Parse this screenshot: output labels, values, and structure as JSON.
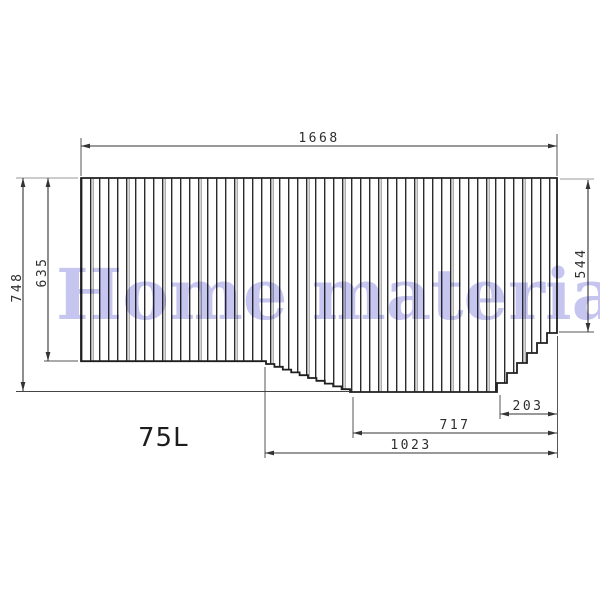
{
  "watermark": {
    "text": "Home material",
    "color": "#c5c5f0"
  },
  "product": {
    "size_label": "75L"
  },
  "dimensions": {
    "top_width": "1668",
    "overall_height": "748",
    "left_section_height": "635",
    "right_section_height": "544",
    "bottom_right_width": "203",
    "bottom_middle_width": "717",
    "bottom_left_width": "1023"
  },
  "colors": {
    "outline": "#1f1f1f",
    "dimension_line": "#333333",
    "extension_line": "#999999",
    "slat_shadow": "#9b9b9b",
    "watermark": "#c5c5f0"
  }
}
